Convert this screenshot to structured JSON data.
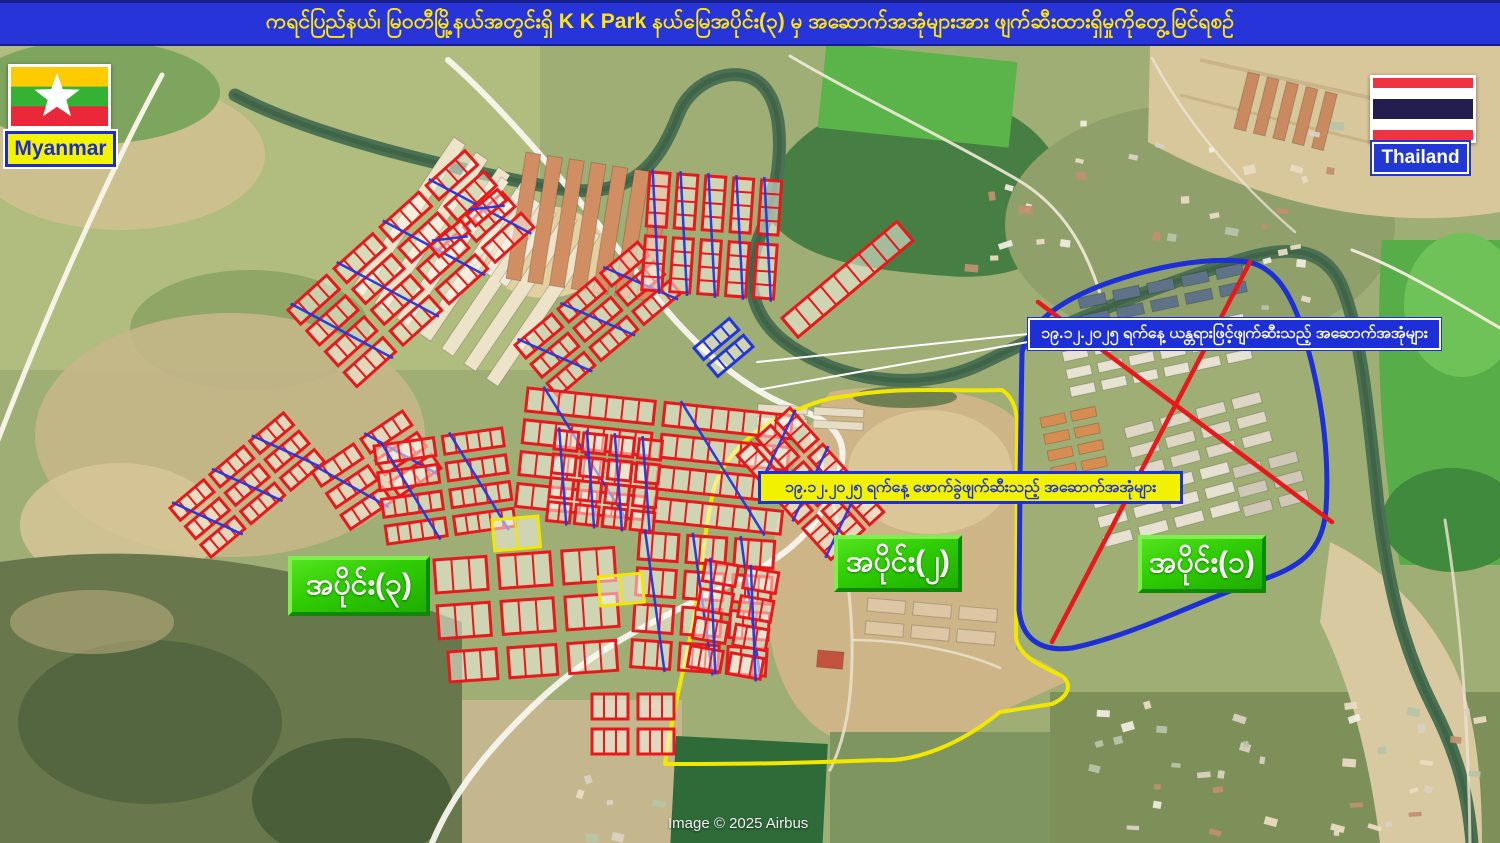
{
  "title_bar": {
    "text": "ကရင်ပြည်နယ်၊ မြဝတီမြို့နယ်အတွင်းရှိ  K K Park နယ်မြေအပိုင်း(၃) မှ အဆောက်အအုံများအား ဖျက်ဆီးထားရှိမှုကိုတွေ့မြင်ရစဉ်",
    "bg_color": "#2634d9",
    "text_color": "#ffe60a"
  },
  "flags": {
    "myanmar": {
      "label": "Myanmar"
    },
    "thailand": {
      "label": "Thailand"
    }
  },
  "map": {
    "sections": [
      {
        "id": "section-1",
        "label": "အပိုင်း(၁)"
      },
      {
        "id": "section-2",
        "label": "အပိုင်း(၂)"
      },
      {
        "id": "section-3",
        "label": "အပိုင်း(၃)"
      }
    ],
    "callouts": {
      "machinery": {
        "text": "၁၉.၁၂.၂၀၂၅ ရက်နေ့ ယန္တရားဖြင့်ဖျက်ဆီးသည့် အဆောက်အအုံများ",
        "style": "blue"
      },
      "demolition": {
        "text": "၁၉.၁၂.၂၀၂၅ ရက်နေ့ ဖောက်ခွဲဖျက်ဆီးသည့် အဆောက်အအုံများ",
        "style": "yellow"
      }
    },
    "annotation_colors": {
      "destroyed_outline": "#e8191c",
      "cross_mark": "#2336dd",
      "section1_boundary": "#1d2fd6",
      "section2_boundary": "#f0e800",
      "razed_lines": "#e8191c",
      "yellow_outline": "#f0e800"
    },
    "attribution": "Image © 2025 Airbus"
  }
}
